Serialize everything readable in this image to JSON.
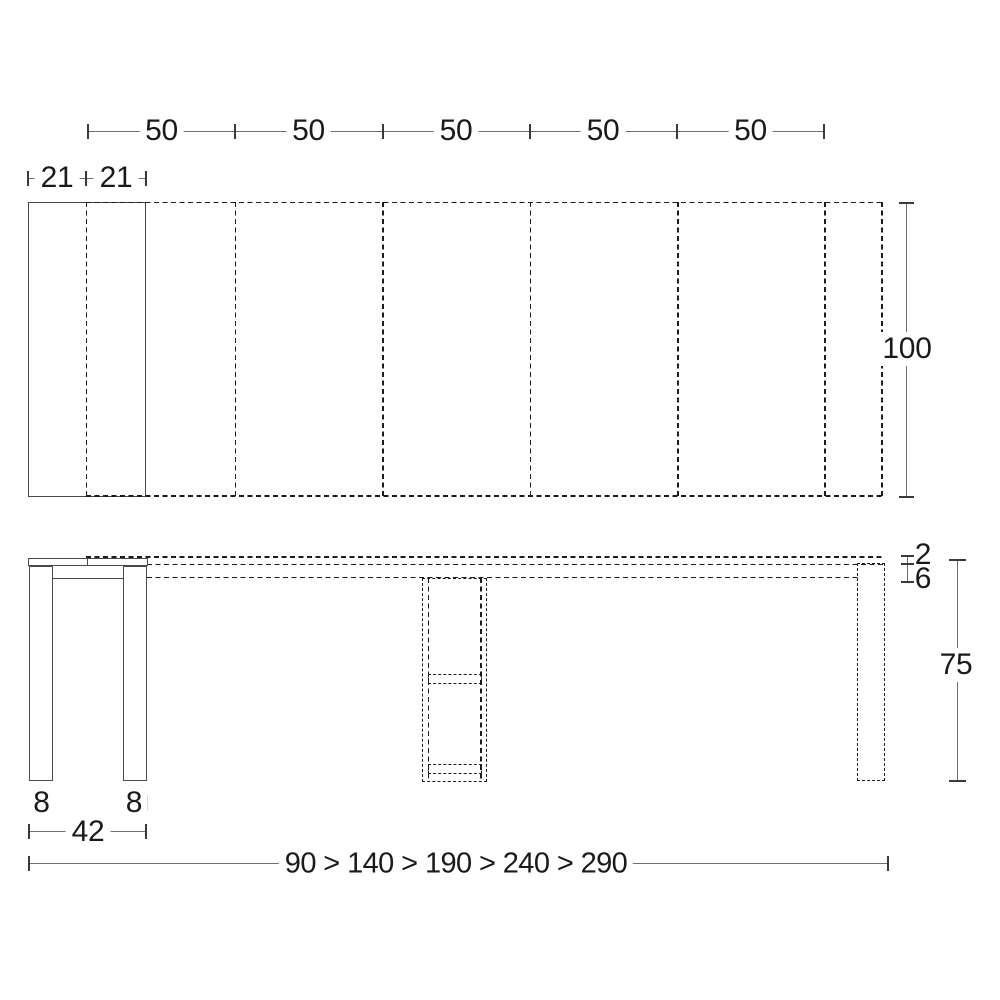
{
  "colors": {
    "background": "#ffffff",
    "solid_line": "#4a4a4a",
    "dashed_line": "#1c1c1c",
    "dimension_line": "#6e6e6e",
    "text": "#1a1a1a"
  },
  "plan_view": {
    "segment_labels": [
      "50",
      "50",
      "50",
      "50",
      "50"
    ],
    "leaf_labels": [
      "21",
      "21"
    ],
    "depth_label": "100"
  },
  "side_view": {
    "top_thickness_label": "2",
    "frame_height_label": "6",
    "height_label": "75",
    "leg_labels": [
      "8",
      "8"
    ],
    "base_label": "42",
    "lengths_label": "90 > 140 > 190 > 240 > 290"
  }
}
